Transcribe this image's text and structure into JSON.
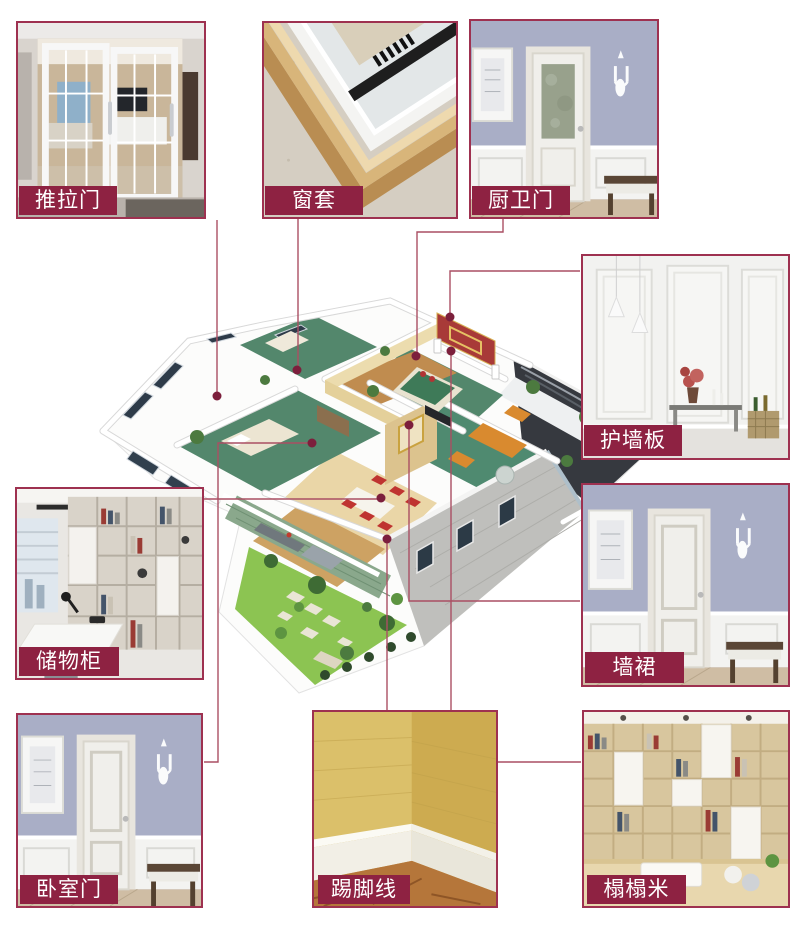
{
  "colors": {
    "background": "#ffffff",
    "badge_bg": "#8e2242",
    "badge_text": "#ffffff",
    "photo_border": "#9e3150",
    "connector": "#aa4f63",
    "marker": "#7c1f3c"
  },
  "products": [
    {
      "id": "sliding-door",
      "label": "推拉门"
    },
    {
      "id": "window-casing",
      "label": "窗套"
    },
    {
      "id": "kitchen-bath-door",
      "label": "厨卫门"
    },
    {
      "id": "wall-panel",
      "label": "护墙板"
    },
    {
      "id": "wainscot",
      "label": "墙裙"
    },
    {
      "id": "tatami",
      "label": "榻榻米"
    },
    {
      "id": "storage-cabinet",
      "label": "储物柜"
    },
    {
      "id": "bedroom-door",
      "label": "卧室门"
    },
    {
      "id": "skirting-line",
      "label": "踢脚线"
    }
  ]
}
